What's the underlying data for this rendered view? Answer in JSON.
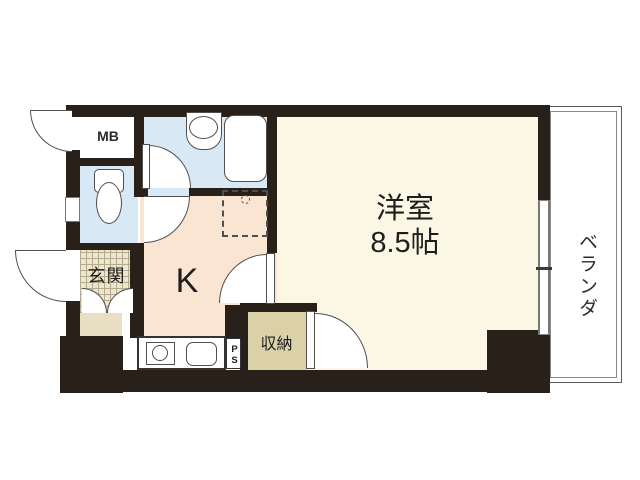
{
  "plan": {
    "title": "apartment-floor-plan",
    "rooms": {
      "mb": {
        "label": "MB"
      },
      "entrance": {
        "label": "玄関"
      },
      "kitchen": {
        "label": "K"
      },
      "storage": {
        "label": "収納"
      },
      "pipe_space": {
        "label": "PS"
      },
      "main_room": {
        "label": "洋室",
        "size": "8.5帖"
      },
      "veranda": {
        "label": "ベランダ"
      }
    },
    "colors": {
      "wall": "#292019",
      "cream": "#FBF7E5",
      "peach": "#FAE4D2",
      "blue": "#D8E9F5",
      "tan": "#DBD1A9",
      "beige": "#E8DFC4",
      "tile_bg": "#EDE6CD",
      "tile_line": "#B3AA90",
      "line": "#4F4F4F"
    }
  }
}
